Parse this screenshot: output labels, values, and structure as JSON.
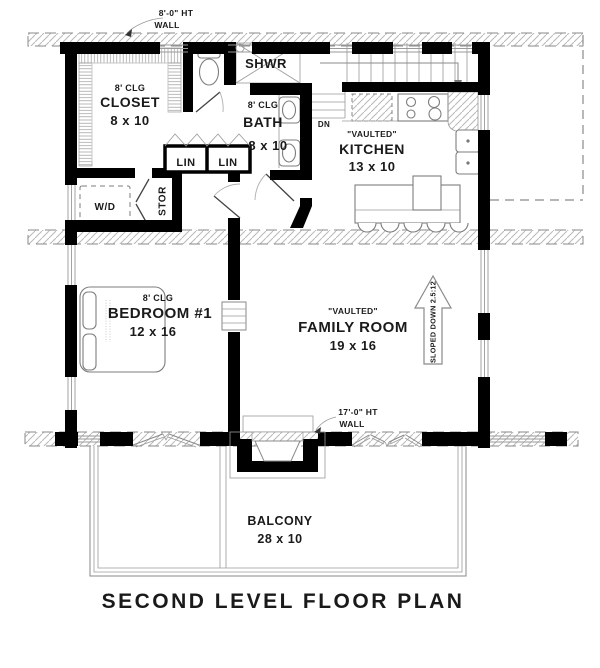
{
  "colors": {
    "wall": "#000000",
    "line_light": "#8a8a8a",
    "hatch": "#b8b8b8",
    "text": "#1a1a1a",
    "background": "#ffffff"
  },
  "plan": {
    "title": "SECOND LEVEL FLOOR PLAN",
    "annotations": {
      "upper_wall_height": {
        "line1": "8'-0\" HT",
        "line2": "WALL"
      },
      "lower_wall_height": {
        "line1": "17'-0\" HT",
        "line2": "WALL"
      },
      "stair_direction": "DN",
      "roof_slope": "SLOPED DOWN 2.5:12"
    },
    "rooms": {
      "closet": {
        "ceiling": "8' CLG",
        "name": "CLOSET",
        "size": "8 x 10"
      },
      "shower": {
        "name": "SHWR"
      },
      "bath": {
        "ceiling": "8' CLG",
        "name": "BATH",
        "size": "8 x 10"
      },
      "linen_left": {
        "name": "LIN"
      },
      "linen_right": {
        "name": "LIN"
      },
      "storage": {
        "name": "STOR"
      },
      "laundry": {
        "name": "W/D"
      },
      "kitchen": {
        "note": "\"VAULTED\"",
        "name": "KITCHEN",
        "size": "13 x 10"
      },
      "bedroom1": {
        "ceiling": "8' CLG",
        "name": "BEDROOM #1",
        "size": "12 x 16"
      },
      "family_room": {
        "note": "\"VAULTED\"",
        "name": "FAMILY ROOM",
        "size": "19 x 16"
      },
      "balcony": {
        "name": "BALCONY",
        "size": "28 x 10"
      }
    }
  }
}
